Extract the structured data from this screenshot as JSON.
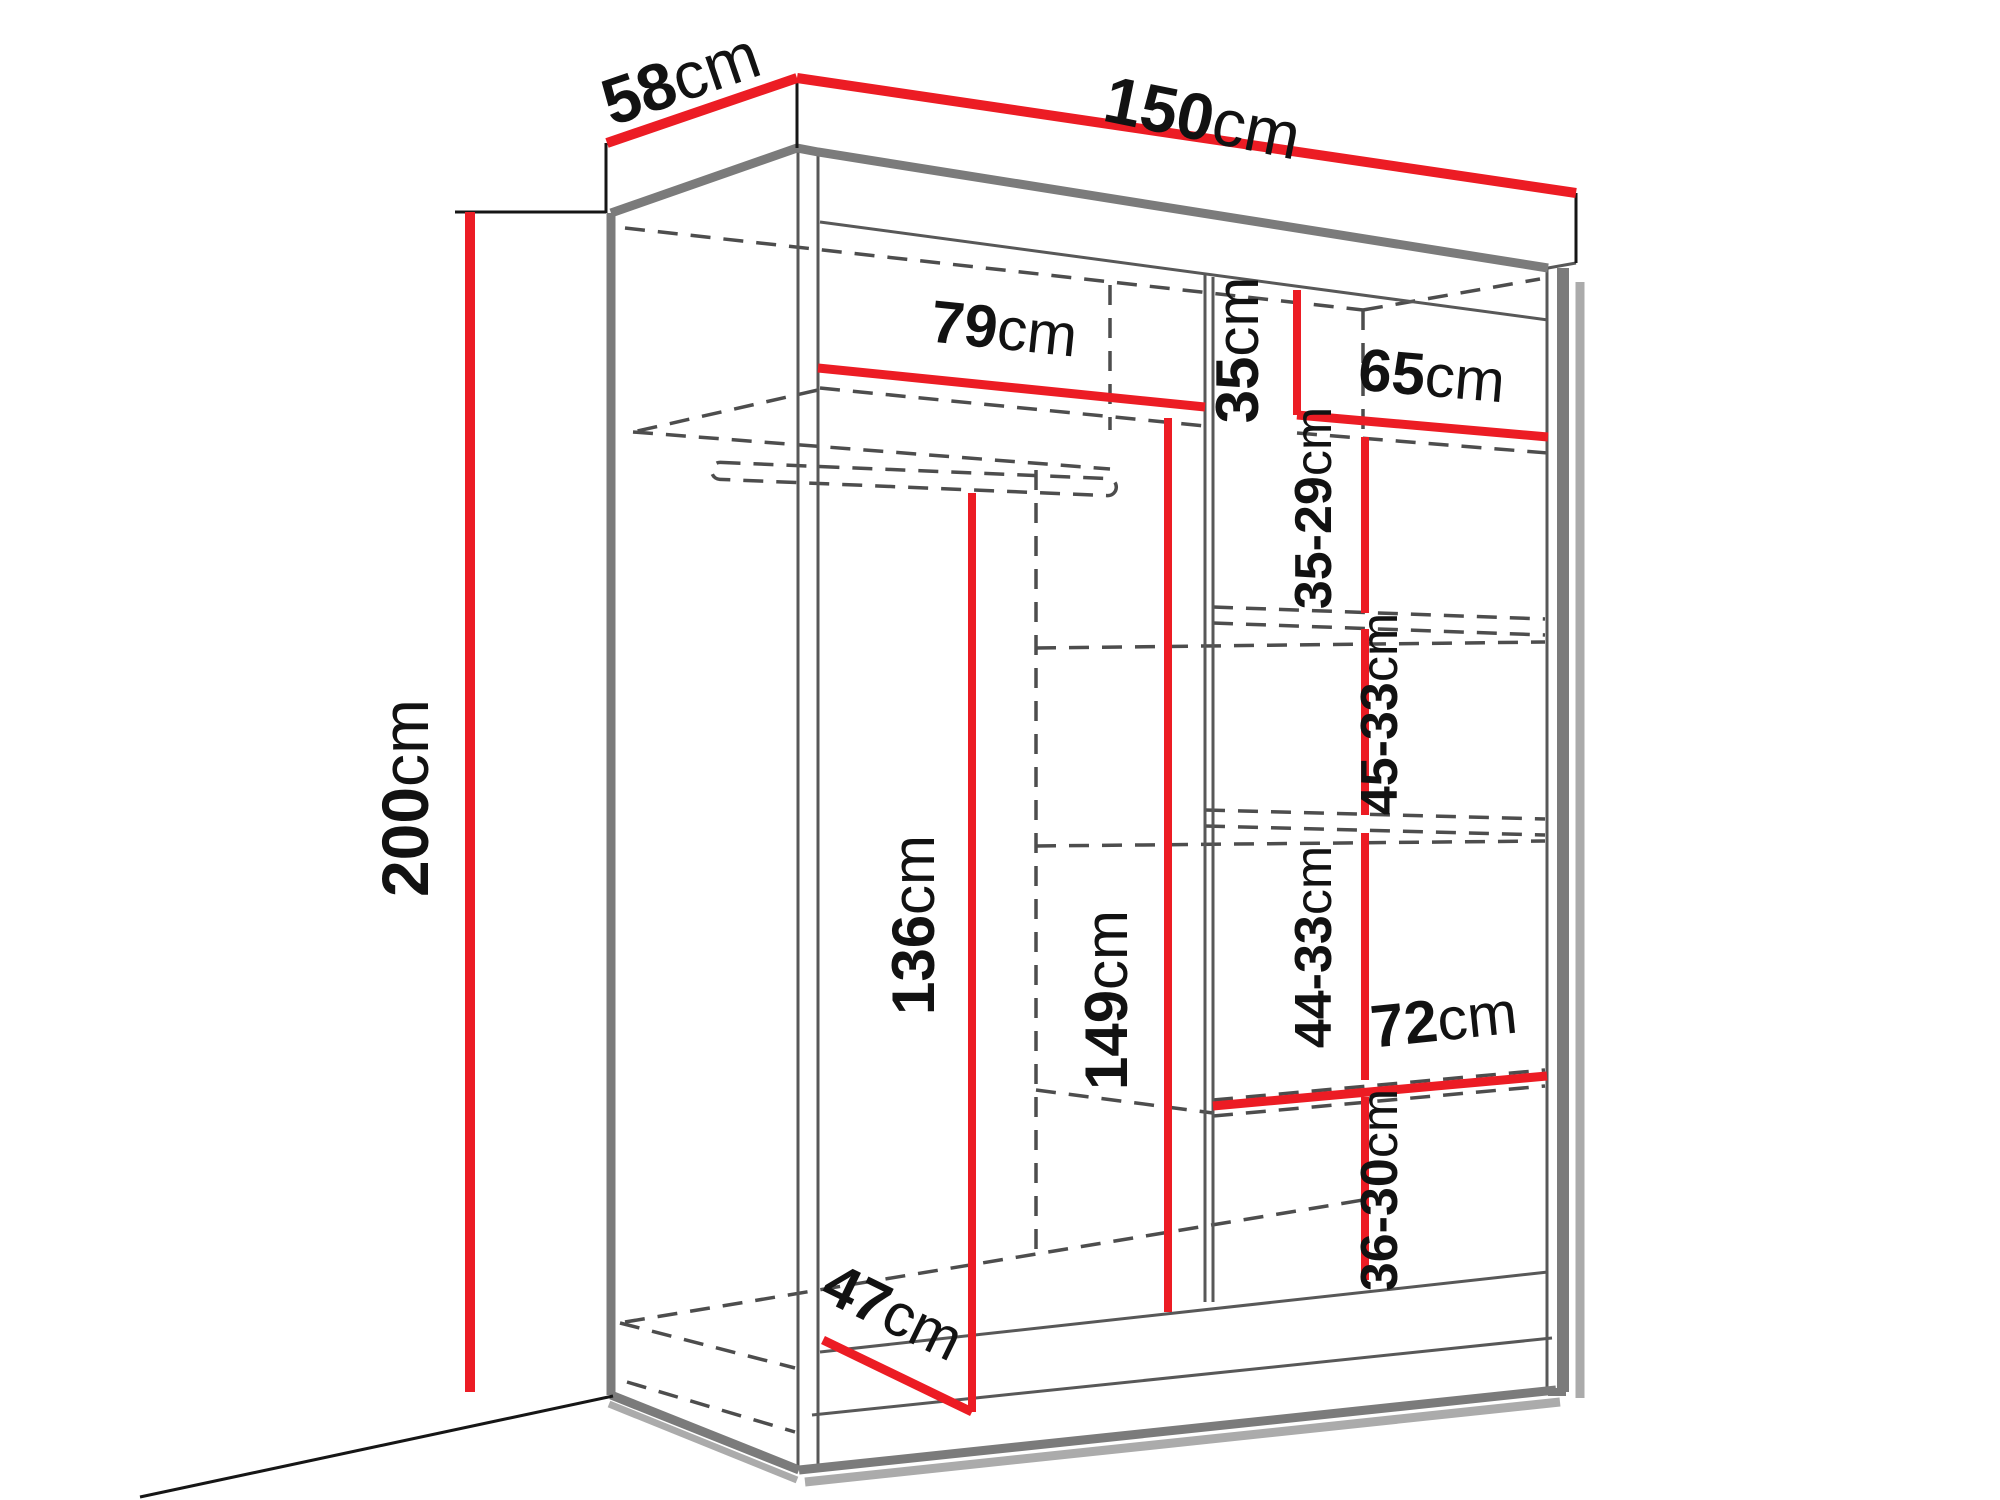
{
  "diagram": {
    "type": "furniture dimension diagram",
    "subject": "two-door sliding wardrobe with shelves and hanging rail",
    "colors": {
      "dimension_line": "#ec1c24",
      "outline": "#7b7b7b",
      "hidden_edge": "#4d4d4d",
      "text": "#121212",
      "background": "#ffffff"
    },
    "dims": {
      "depth": {
        "num": "58",
        "unit": "cm"
      },
      "width": {
        "num": "150",
        "unit": "cm"
      },
      "height": {
        "num": "200",
        "unit": "cm"
      },
      "left_shelf": {
        "num": "79",
        "unit": "cm"
      },
      "top_cubby": {
        "num": "35",
        "unit": "cm"
      },
      "right_width": {
        "num": "65",
        "unit": "cm"
      },
      "right_gap_1": {
        "num": "35-29",
        "unit": "cm"
      },
      "right_gap_2": {
        "num": "45-33",
        "unit": "cm"
      },
      "right_gap_3": {
        "num": "44-33",
        "unit": "cm"
      },
      "right_gap_4": {
        "num": "36-30",
        "unit": "cm"
      },
      "hanging_left": {
        "num": "136",
        "unit": "cm"
      },
      "hanging_mid": {
        "num": "149",
        "unit": "cm"
      },
      "bottom_depth": {
        "num": "47",
        "unit": "cm"
      },
      "bottom_shelf": {
        "num": "72",
        "unit": "cm"
      }
    }
  }
}
